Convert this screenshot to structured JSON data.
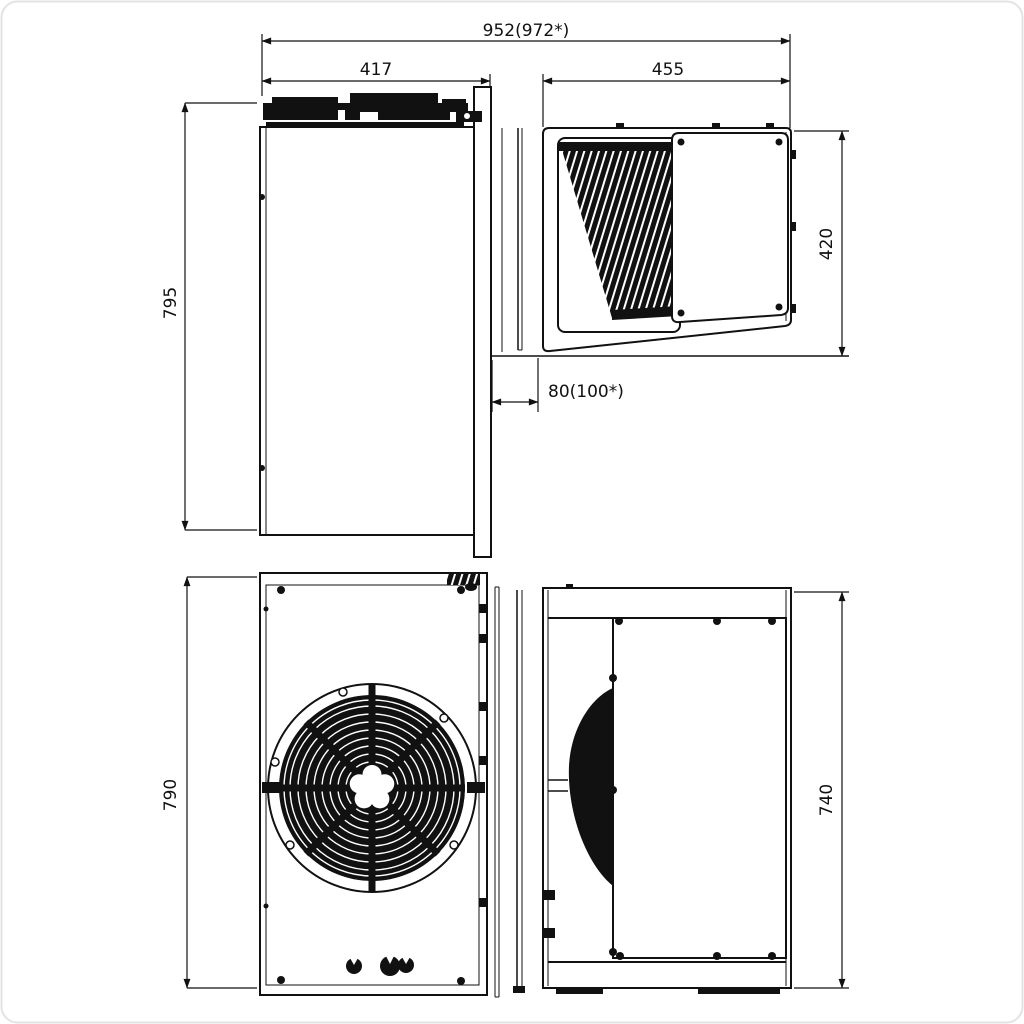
{
  "page": {
    "background": "#ffffff",
    "ink_color": "#111111",
    "frame_color": "#e3e3e3"
  },
  "drawing": {
    "dimensions": {
      "overall_width": "952(972*)",
      "left_width": "417",
      "right_width": "455",
      "left_height": "795",
      "right_depth": "420",
      "wall_gap": "80(100*)",
      "front_height": "790",
      "side_depth": "740"
    }
  }
}
